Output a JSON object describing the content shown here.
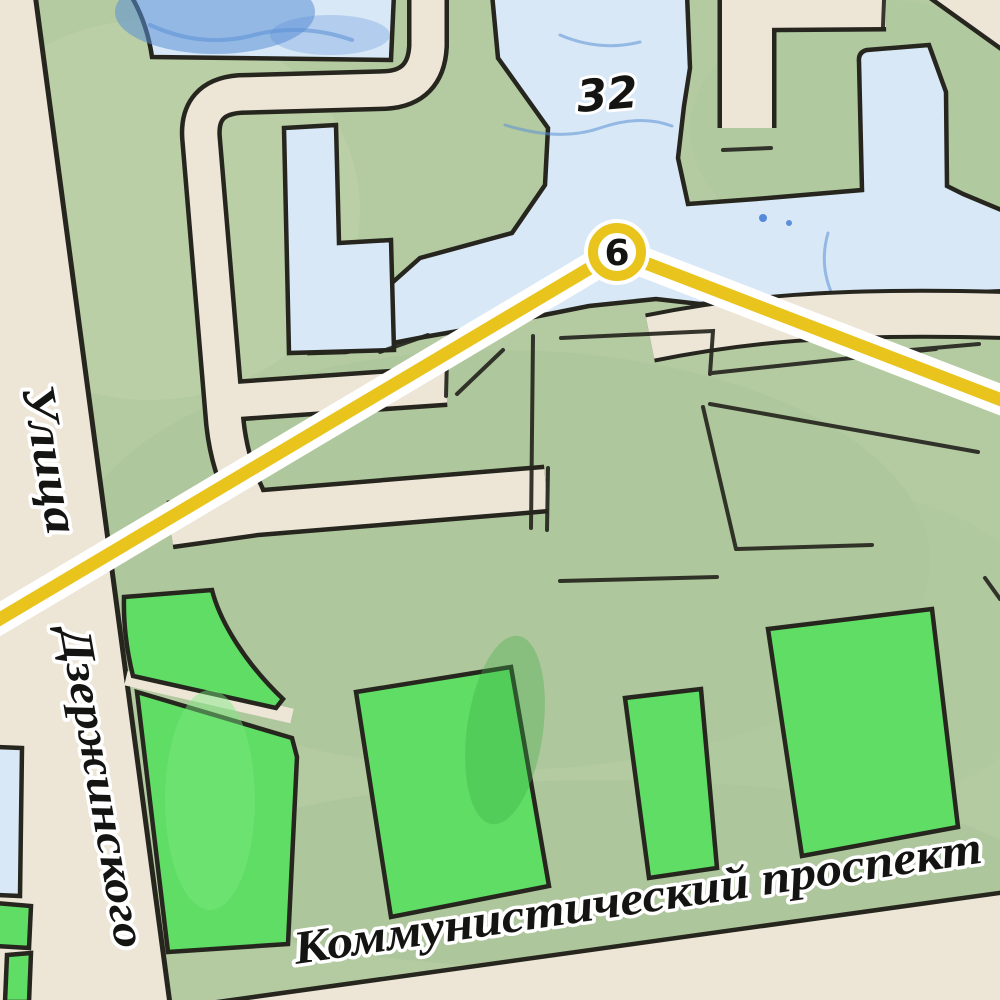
{
  "map": {
    "title": "Hand-drawn city map with transit route",
    "labels": {
      "street_prefix": "Улица",
      "street_name": "Дзержинского",
      "avenue_name": "Коммунистический  проспект",
      "block_number": "32",
      "route_stop": "6"
    },
    "colors": {
      "background_green": "#b4cba1",
      "park_green": "#5fdd64",
      "building_blue": "#d8e8f6",
      "water_blue": "#5b8fd6",
      "road_beige": "#ede6d7",
      "route_yellow": "#e9c41c",
      "route_casing": "#ffffff",
      "outline_black": "#26261f",
      "text_black": "#141412",
      "halo_white": "#ffffff"
    }
  }
}
